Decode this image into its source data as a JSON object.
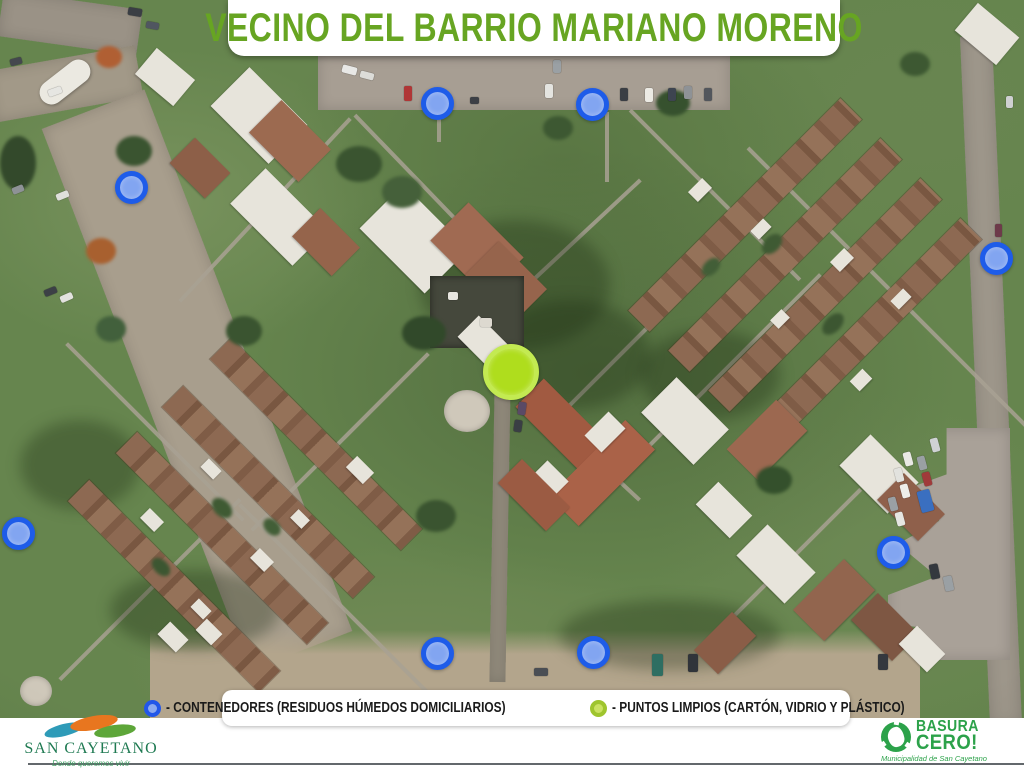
{
  "theme": {
    "title_green": "#67a522",
    "legend_text": "#1a1a1a",
    "sc_green": "#1f7a52",
    "bc_green": "#2ca24a"
  },
  "title_banner": {
    "title": "VECINO DEL BARRIO MARIANO MORENO"
  },
  "legend": {
    "items": [
      {
        "id": "contenedores",
        "label": "- CONTENEDORES (RESIDUOS HÚMEDOS DOMICILIARIOS)",
        "dot_fill": "#8caaf0",
        "dot_border": "#2257e9"
      },
      {
        "id": "puntos_limpios",
        "label": "- PUNTOS LIMPIOS (CARTÓN, VIDRIO Y PLÁSTICO)",
        "dot_fill": "#cbe262",
        "dot_border": "#9fc52e"
      }
    ]
  },
  "footer": {
    "municipality": {
      "name": "SAN CAYETANO",
      "tagline": "Donde queremos vivir"
    },
    "program": {
      "name_line1": "BASURA",
      "name_line2": "CERO!",
      "tagline": "Municipalidad de San Cayetano"
    }
  },
  "map": {
    "marker_styles": {
      "contenedor": {
        "fill": "#82a5f1",
        "border": "#1e5ce9",
        "diameter": 33,
        "border_width": 5
      },
      "punto_limpio": {
        "fill": "#afdd1d",
        "border": "#c3ea52",
        "diameter": 56,
        "border_width": 5
      }
    },
    "markers": [
      {
        "type": "contenedor",
        "x": 437,
        "y": 103
      },
      {
        "type": "contenedor",
        "x": 592,
        "y": 104
      },
      {
        "type": "contenedor",
        "x": 131,
        "y": 187
      },
      {
        "type": "contenedor",
        "x": 996,
        "y": 258
      },
      {
        "type": "contenedor",
        "x": 18,
        "y": 533
      },
      {
        "type": "contenedor",
        "x": 893,
        "y": 552
      },
      {
        "type": "contenedor",
        "x": 437,
        "y": 653
      },
      {
        "type": "contenedor",
        "x": 593,
        "y": 652
      },
      {
        "type": "punto_limpio",
        "x": 511,
        "y": 372
      }
    ]
  }
}
